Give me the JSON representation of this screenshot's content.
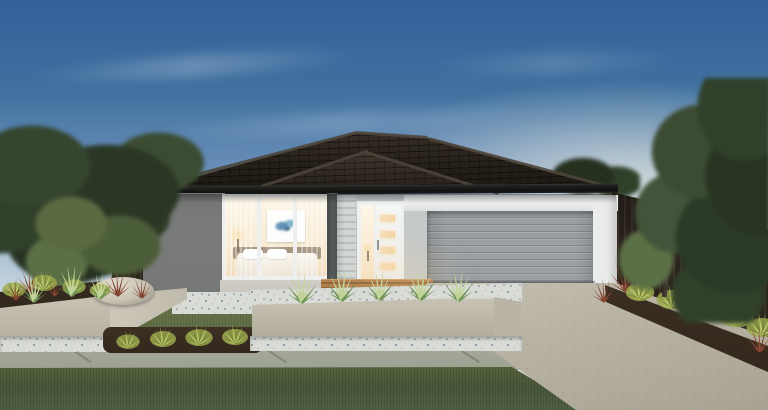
{
  "scene": {
    "type": "architectural-render",
    "description": "Dusk front-elevation render of a single-storey house: dark tiled hip roof, dark grey feature wall, warmly lit bedroom window and entry door, grey double garage door with white surround, rendered planter boxes with spiky plants, white pebbles, concrete path, lawn, aggregate driveway, timber fences and trees either side",
    "objects": {
      "sky": "Dusk sky gradient with wispy clouds",
      "roof": "Dark charcoal tiled hip roof with ridge capping",
      "dark_wall": "Dark grey rendered feature wall",
      "window": "Lit bedroom picture window with artwork and bed visible",
      "door": "White entry door with four lit glass slots and lit sidelight",
      "garage": "Grey sectional double garage door with white lintel and pillar",
      "left_planter": "Rendered raised garden bed with mulch, grasses and boulder",
      "center_planter": "Long rendered planter with white pebbles and five agaves",
      "driveway": "Exposed-aggregate concrete driveway",
      "path": "Concrete front path with expansion joints",
      "lawn": "Manicured lawn strips",
      "right_garden": "Mulched bed of lime shrubs and red cordylines along timber fence",
      "trees": "Screening trees on both boundaries"
    }
  },
  "palette": {
    "sky-top": "#33609b",
    "sky-mid": "#6b90ba",
    "sky-low": "#c3d3de",
    "sky-horizon": "#f0f1ea",
    "cloud": "#ffffff",
    "roof-hi": "#4a4138",
    "roof-dark": "#241f18",
    "fascia": "#121110",
    "wall-dark": "#797b7a",
    "render-light": "#c5c9c9",
    "sill": "#c9c6bf",
    "white-trim": "#eef0ef",
    "lintel": "#e9ebea",
    "clad": "#d2d6d5",
    "clad-line": "#bac0bf",
    "post": "#565b59",
    "glass-top": "#fdf6e8",
    "glass-bot": "#f2ddc0",
    "door-glow": "#f4d7a6",
    "garage": "#9b9fa2",
    "garage-line": "#83878b",
    "garage-hi": "#a9adb0",
    "pillar": "#e8eae9",
    "fence": "#2a231c",
    "fence-line": "#3a3129",
    "tree-dark": "#2a3725",
    "tree-mid": "#3c4c33",
    "tree-light": "#5c7046",
    "lawn-mid": "#66744a",
    "lawn-dark": "#49573a",
    "pebble": "#d9dbd6",
    "mulch": "#33281d",
    "planter": "#c7c2b3",
    "planter-dark": "#b0ab9b",
    "planter-top": "#d8d4c6",
    "path": "#a6aa9b",
    "joint": "#7b7f70",
    "drive-hi": "#c6c2b4",
    "drive-lo": "#a8a393",
    "bush-light": "#c2cc6c",
    "bush-mid": "#9aa84c",
    "bush-dark": "#77863c",
    "agave": "#6f9454",
    "agave-light": "#c2d398",
    "red-plant": "#76392a",
    "red-plant2": "#94543a",
    "deck": "#b3804c",
    "deck-line": "#8f653c",
    "boulder": "#e0dbce"
  }
}
